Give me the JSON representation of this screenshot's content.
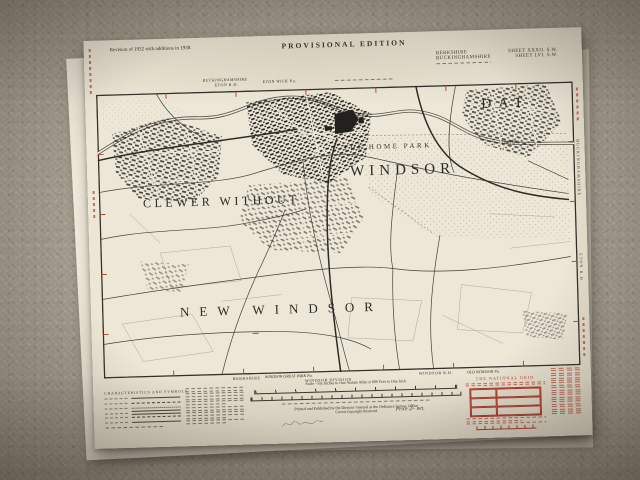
{
  "colors": {
    "paper": "#ece5d4",
    "ink": "#2f2c26",
    "red": "#b23b2c",
    "carpet": "#a49c8e"
  },
  "header": {
    "revision_note": "Revision of 1932 with additions in 1938.",
    "edition": "PROVISIONAL EDITION",
    "county_rows": [
      {
        "county": "BERKSHIRE",
        "sheet": "SHEET XXXII. S.W."
      },
      {
        "county": "BUCKINGHAMSHIRE",
        "sheet": "SHEET LVI. S.W."
      }
    ]
  },
  "map": {
    "margin_top": {
      "county": "BUCKINGHAMSHIRE",
      "district": "ETON R.D.",
      "parish": "ETON WICK Pa."
    },
    "margin_right": {
      "county": "BUCKINGHAMSHIRE",
      "district": "ETON R.D."
    },
    "margin_bottom": {
      "county": "BERKSHIRE",
      "parish_left": "WINDSOR GREAT PARK Pa.",
      "division": "WINDSOR DIVISION",
      "district": "WINDSOR R.D.",
      "parish_right": "OLD WINDSOR Pa."
    },
    "labels": {
      "datchet_large": "DAT",
      "datchet_small": "Datchet",
      "home_park": "THE HOME PARK",
      "windsor": "WINDSOR",
      "clewer_without": "CLEWER WITHOUT",
      "new_windsor": "NEW WINDSOR"
    }
  },
  "footer": {
    "legend_title": "CHARACTERISTICS AND SYMBOLS",
    "scale_text": "Scale - Six Inches to One Statute Mile or 880 Feet to One Inch",
    "imprint_line1": "Printed and Published by the Director General at the Ordnance Survey Office",
    "imprint_line2": "Crown Copyright Reserved",
    "price": "Price 2/- net.",
    "national_grid_title": "THE NATIONAL GRID"
  }
}
